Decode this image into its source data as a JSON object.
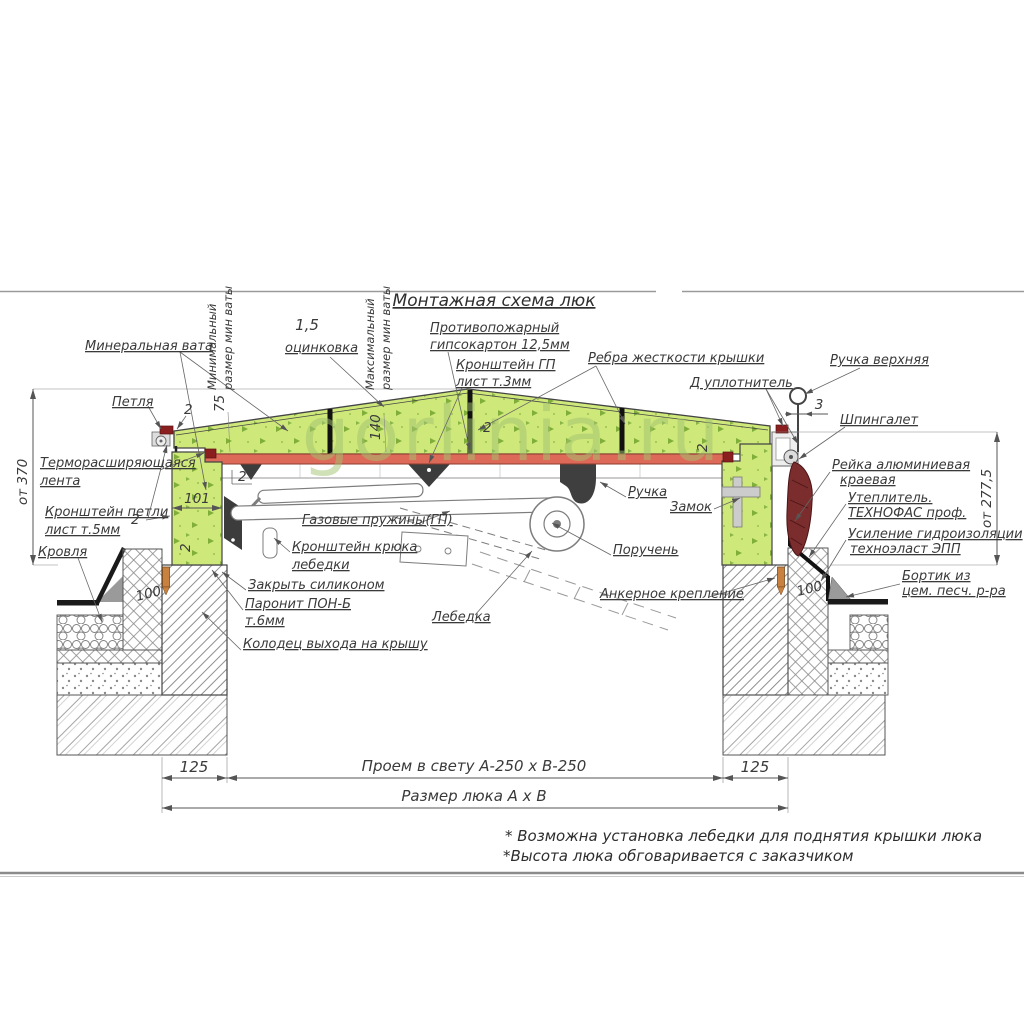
{
  "title": "Монтажная схема люк",
  "watermark": "gorlinia.ru",
  "colors": {
    "wool_green": "#cfe87a",
    "wool_speckle": "#7fae3a",
    "gypsum_red": "#dd6a58",
    "seal_dark_red": "#8b1f1f",
    "lever_maroon": "#7b2d2d",
    "anchor_pin_orange": "#c8813f",
    "line_gray": "#555555",
    "watermark_green": "#a3c472"
  },
  "labels": {
    "mineral_wool": "Минеральная вата",
    "hinge": "Петля",
    "min_size_1": "Минимальный",
    "min_size_2": "размер мин ваты",
    "galv_value": "1,5",
    "galv": "оцинковка",
    "max_size_1": "Максимальный",
    "max_size_2": "размер мин ваты",
    "fireproof_1": "Противопожарный",
    "fireproof_2": "гипсокартон 12,5мм",
    "gp_bracket_1": "Кронштейн ГП",
    "gp_bracket_2": "лист т.3мм",
    "ribs": "Ребра жесткости крышки",
    "d_seal": "Д уплотнитель",
    "handle_top": "Ручка верхняя",
    "latch": "Шпингалет",
    "thermal_tape_1": "Терморасширяющаяся",
    "thermal_tape_2": "лента",
    "hinge_bracket_1": "Кронштейн петли",
    "hinge_bracket_2": "лист т.5мм",
    "roof": "Кровля",
    "gas_springs": "Газовые пружины(ГП)",
    "hook_bracket_1": "Кронштейн крюка",
    "hook_bracket_2": "лебедки",
    "silicone": "Закрыть силиконом",
    "paronite_1": "Паронит ПОН-Б",
    "paronite_2": "т.6мм",
    "well": "Колодец выхода на крышу",
    "handle": "Ручка",
    "lock": "Замок",
    "handrail": "Поручень",
    "winch": "Лебедка",
    "anchor": "Анкерное крепление",
    "rail_1": "Рейка алюминиевая",
    "rail_2": "краевая",
    "insulation_1": "Утеплитель.",
    "insulation_2": "ТЕХНОФАС проф.",
    "waterproof_1": "Усиление гидроизоляции",
    "waterproof_2": "техноэласт ЭПП",
    "curb_1": "Бортик из",
    "curb_2": "цем. песч. р-ра"
  },
  "dims": {
    "h_left": "от 370",
    "h_right": "от 277,5",
    "min_wool": "75",
    "max_wool": "140",
    "frame_w": "101",
    "wall_l": "125",
    "wall_r": "125",
    "ins_l": "100",
    "ins_r": "100",
    "rod_offset": "3",
    "t2": "2",
    "opening": "Проем в свету А-250 х В-250",
    "hatch_size": "Размер люка А х В"
  },
  "notes": {
    "n1": "* Возможна установка лебедки для поднятия крышки люка",
    "n2": "*Высота люка обговаривается с заказчиком"
  }
}
